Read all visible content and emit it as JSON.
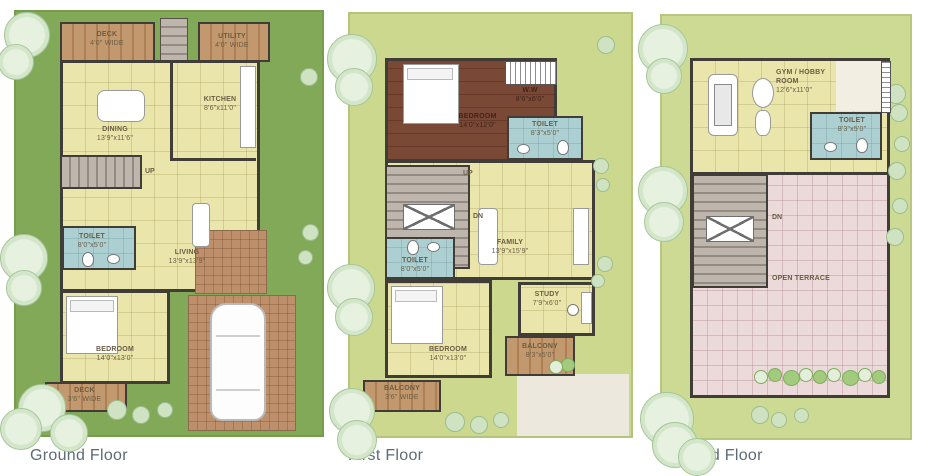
{
  "colors": {
    "plot_ground": "#82a957",
    "plot_upper": "#cbd88d",
    "interior": "#eae6ab",
    "wood_deck": "#c2996e",
    "wood_dark": "#7a4936",
    "toilet": "#acd0d2",
    "terrace": "#ecdadb",
    "paving": "#bd906b",
    "wall": "#403c38",
    "caption_text": "#5e6a74"
  },
  "floors": [
    {
      "caption": "Ground Floor",
      "rooms": {
        "deck_top": {
          "name": "DECK",
          "dim": "4'0\" WIDE"
        },
        "utility": {
          "name": "UTILITY",
          "dim": "4'0\" WIDE"
        },
        "kitchen": {
          "name": "KITCHEN",
          "dim": "8'6\"x11'0\""
        },
        "dining": {
          "name": "DINING",
          "dim": "13'9\"x11'6\""
        },
        "toilet": {
          "name": "TOILET",
          "dim": "8'0\"x5'0\""
        },
        "living": {
          "name": "LIVING",
          "dim": "13'9\"x13'9\""
        },
        "bedroom": {
          "name": "BEDROOM",
          "dim": "14'0\"x13'0\""
        },
        "deck_bottom": {
          "name": "DECK",
          "dim": "3'6\" WIDE"
        },
        "stairs_up": "UP"
      }
    },
    {
      "caption": "First Floor",
      "rooms": {
        "bedroom_master": {
          "name": "BEDROOM",
          "dim": "14'0\"x12'0\""
        },
        "ww": {
          "name": "W.W",
          "dim": "8'6\"x6'0\""
        },
        "toilet_master": {
          "name": "TOILET",
          "dim": "8'3\"x5'0\""
        },
        "family": {
          "name": "FAMILY",
          "dim": "13'9\"x15'9\""
        },
        "toilet": {
          "name": "TOILET",
          "dim": "8'0\"x5'0\""
        },
        "bedroom": {
          "name": "BEDROOM",
          "dim": "14'0\"x13'0\""
        },
        "study": {
          "name": "STUDY",
          "dim": "7'9\"x6'0\""
        },
        "balcony_right": {
          "name": "BALCONY",
          "dim": "8'3\"x5'0\""
        },
        "balcony_bottom": {
          "name": "BALCONY",
          "dim": "3'6\" WIDE"
        },
        "stairs_up": "UP",
        "stairs_dn": "DN"
      }
    },
    {
      "caption": "Second Floor",
      "rooms": {
        "gym": {
          "name": "GYM / HOBBY",
          "name2": "ROOM",
          "dim": "12'6\"x11'0\""
        },
        "toilet": {
          "name": "TOILET",
          "dim": "8'3\"x5'0\""
        },
        "terrace": {
          "name": "OPEN TERRACE"
        },
        "stairs_dn": "DN"
      }
    }
  ]
}
